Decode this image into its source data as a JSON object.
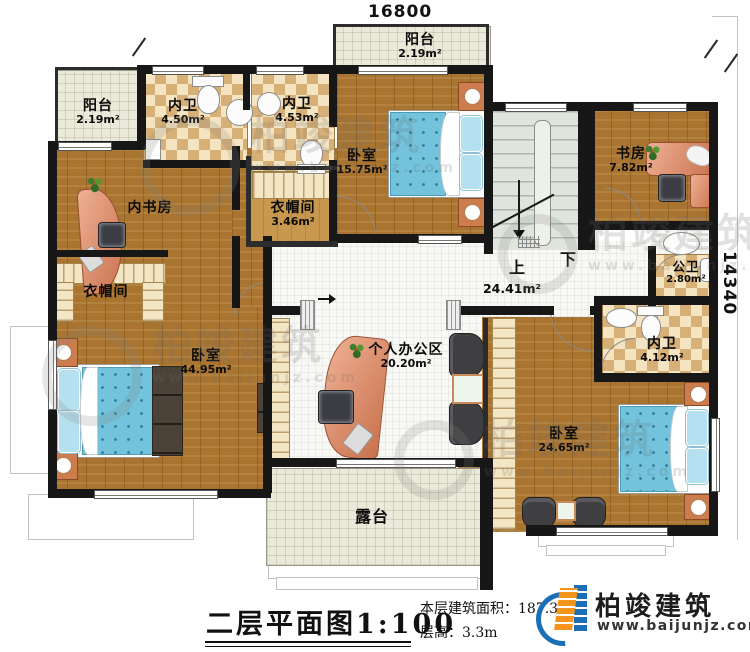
{
  "dimensions": {
    "top_width": "16800",
    "right_height": "14340"
  },
  "rooms": [
    {
      "id": "balcony-top-left",
      "name": "阳台",
      "area": "2.19m²"
    },
    {
      "id": "bath-top-a",
      "name": "内卫",
      "area": "4.50m²"
    },
    {
      "id": "bath-top-b",
      "name": "内卫",
      "area": "4.53m²"
    },
    {
      "id": "bedroom-top",
      "name": "卧室",
      "area": "15.75m²"
    },
    {
      "id": "balcony-top-center",
      "name": "阳台",
      "area": "2.19m²"
    },
    {
      "id": "study",
      "name": "书房",
      "area": "7.82m²"
    },
    {
      "id": "inner-study",
      "name": "内书房",
      "area": ""
    },
    {
      "id": "closet-center",
      "name": "衣帽间",
      "area": "3.46m²"
    },
    {
      "id": "closet-left",
      "name": "衣帽间",
      "area": ""
    },
    {
      "id": "bedroom-left",
      "name": "卧室",
      "area": "44.95m²"
    },
    {
      "id": "office",
      "name": "个人办公区",
      "area": "20.20m²"
    },
    {
      "id": "public-bath",
      "name": "公卫",
      "area": "2.80m²"
    },
    {
      "id": "bath-right",
      "name": "内卫",
      "area": "4.12m²"
    },
    {
      "id": "bedroom-right",
      "name": "卧室",
      "area": "24.65m²"
    },
    {
      "id": "terrace",
      "name": "露台",
      "area": ""
    },
    {
      "id": "hallway",
      "name": "",
      "area": "24.41m²"
    }
  ],
  "stairs": {
    "up_label": "上",
    "down_label": "下"
  },
  "title_block": {
    "title": "二层平面图",
    "scale": "1:100",
    "area_label": "本层建筑面积：",
    "area_value": "187.38m²",
    "floor_height_label": "层高：",
    "floor_height_value": "3.3m"
  },
  "logo": {
    "company": "柏竣建筑",
    "website": "www.baijunjz.com"
  },
  "watermark": {
    "company": "柏竣建筑",
    "website": "www.baijunjz.com"
  },
  "colors": {
    "wall": "#171717",
    "wood_floor": "#a9742f",
    "tile_floor": "#ebe9d9",
    "checker_dark": "#d7b077",
    "bed_blue": "#72c3db",
    "desk_salmon": "#d98a67",
    "logo_blue": "#1a6fb5",
    "logo_orange": "#f7941d"
  }
}
